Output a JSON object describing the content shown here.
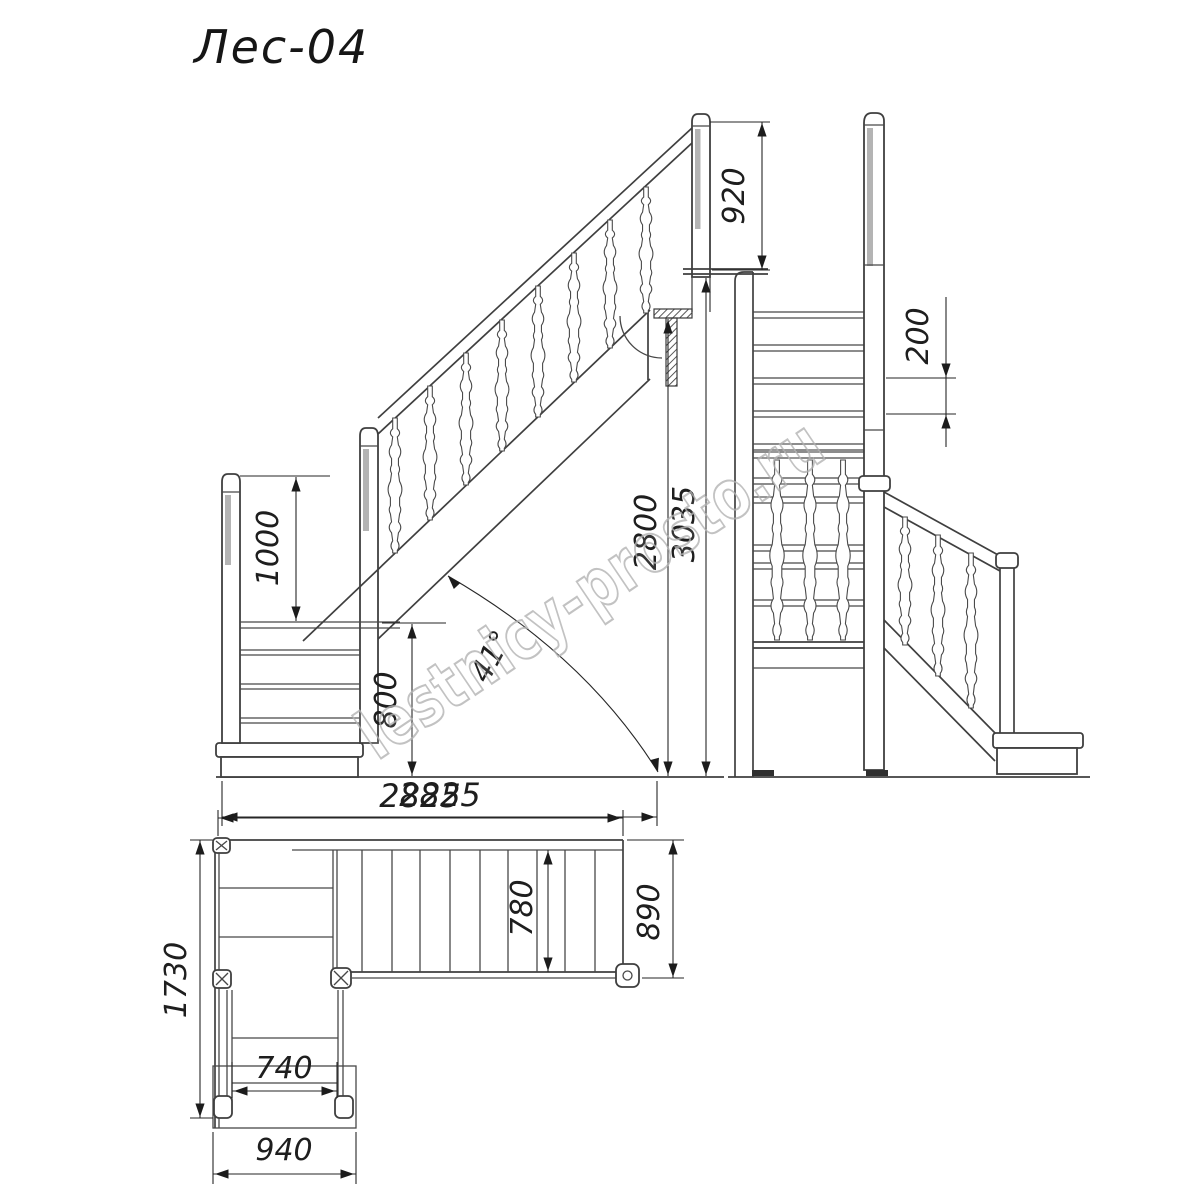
{
  "title": "Лес-04",
  "watermark": "lestnicy-prosto.ru",
  "dimensions": {
    "front": {
      "top_post_height": "920",
      "left_post_height": "1000",
      "lower_flight_height": "800",
      "ceiling_clearance": "2800",
      "total_height": "3035",
      "run_length": "2825",
      "incline_angle": "41°"
    },
    "side": {
      "riser_height": "200"
    },
    "plan": {
      "total_run": "2825",
      "upper_flight_width": "890",
      "tread_clear_width": "780",
      "total_depth": "1730",
      "lower_flight_clear_width": "740",
      "lower_flight_width": "940"
    }
  },
  "colors": {
    "background": "#ffffff",
    "line": "#3f3f3f",
    "dimension": "#262626",
    "post_shading": "#b4b4b4",
    "watermark": "#b3b3b3"
  }
}
